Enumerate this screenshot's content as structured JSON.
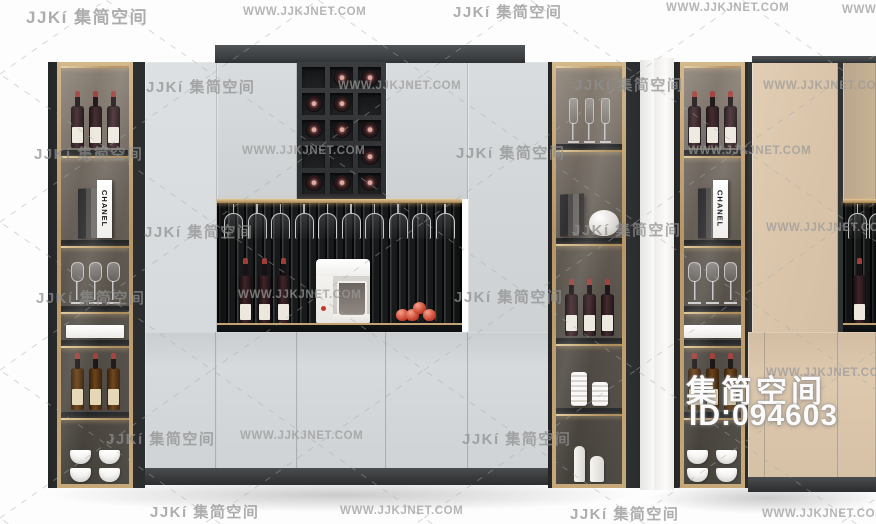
{
  "watermarks": {
    "logo": "JJKí 集简空间",
    "url": "WWW.JJKJNET.COM",
    "items": [
      {
        "t": "logo",
        "x": 26,
        "y": 3,
        "s": 17
      },
      {
        "t": "url",
        "x": 243,
        "y": 6
      },
      {
        "t": "logo",
        "x": 453,
        "y": 1
      },
      {
        "t": "url",
        "x": 666,
        "y": 2
      },
      {
        "t": "url",
        "x": 842,
        "y": 4
      },
      {
        "t": "logo",
        "x": 146,
        "y": 76
      },
      {
        "t": "url",
        "x": 338,
        "y": 80
      },
      {
        "t": "logo",
        "x": 574,
        "y": 74
      },
      {
        "t": "url",
        "x": 763,
        "y": 80
      },
      {
        "t": "logo",
        "x": 34,
        "y": 143
      },
      {
        "t": "url",
        "x": 242,
        "y": 145
      },
      {
        "t": "logo",
        "x": 456,
        "y": 142
      },
      {
        "t": "url",
        "x": 688,
        "y": 145
      },
      {
        "t": "logo",
        "x": 144,
        "y": 221
      },
      {
        "t": "logo",
        "x": 572,
        "y": 219
      },
      {
        "t": "url",
        "x": 766,
        "y": 222
      },
      {
        "t": "logo",
        "x": 36,
        "y": 287
      },
      {
        "t": "url",
        "x": 238,
        "y": 289
      },
      {
        "t": "logo",
        "x": 454,
        "y": 286
      },
      {
        "t": "url",
        "x": 766,
        "y": 367
      },
      {
        "t": "logo",
        "x": 106,
        "y": 428
      },
      {
        "t": "url",
        "x": 240,
        "y": 430
      },
      {
        "t": "logo",
        "x": 462,
        "y": 428
      },
      {
        "t": "logo",
        "x": 150,
        "y": 501
      },
      {
        "t": "url",
        "x": 340,
        "y": 505
      },
      {
        "t": "logo",
        "x": 570,
        "y": 503
      },
      {
        "t": "url",
        "x": 762,
        "y": 508
      }
    ]
  },
  "overlay": {
    "brand": "集简空间",
    "id": "ID:094603"
  },
  "decor": {
    "book_label": "CHANEL"
  },
  "left_cabinet": {
    "left_column": {
      "top_bottles": 3,
      "glasses": 3,
      "boxes": 1,
      "amber_bottles": 3,
      "cup_stacks": 2
    },
    "right_column": {
      "flutes": 3,
      "bottles": 3,
      "cylinders": 2,
      "white_bottles": 2
    },
    "wine_rack": {
      "rows": 5,
      "cols": 3,
      "grid": [
        [
          0,
          1,
          1
        ],
        [
          1,
          1,
          0
        ],
        [
          1,
          1,
          1
        ],
        [
          0,
          0,
          1
        ],
        [
          1,
          1,
          1
        ]
      ]
    },
    "open_shelf": {
      "hanging_glasses": 10,
      "bottles": 3,
      "apples": 4
    }
  },
  "right_cabinet": {
    "left_column": {
      "top_bottles": 3,
      "glasses": 3,
      "boxes": 1,
      "amber_bottles": 3,
      "cup_stacks": 2
    },
    "open_shelf": {
      "hanging_glasses": 2,
      "bottles": 1
    }
  },
  "colors": {
    "gray_door": "#d5d8da",
    "beige_door": "#dcc8ae",
    "dark_frame": "#3a3d3f",
    "gold_trim": "#c2a071",
    "slat_dark": "#1b1c1e",
    "watermark_gray": "#969696",
    "background": "#fdfdfd"
  }
}
